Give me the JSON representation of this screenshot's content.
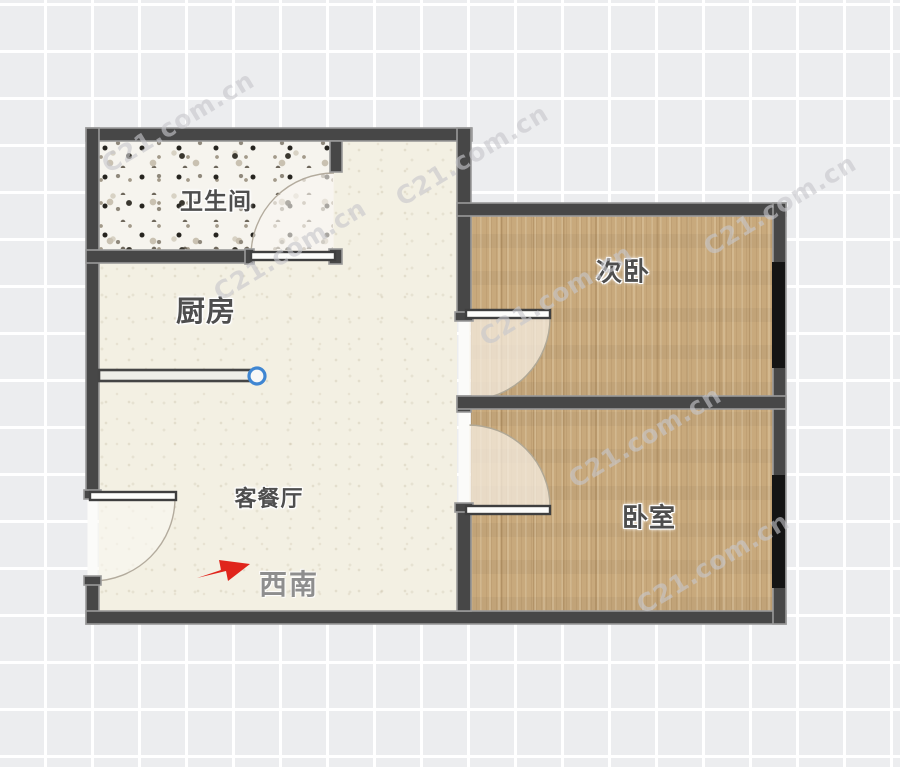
{
  "page": {
    "background_color": "#ecedef",
    "grid_line_color": "#ffffff"
  },
  "floor_plan": {
    "rooms": [
      {
        "id": "bathroom",
        "label": "卫生间",
        "floor": "terrazzo"
      },
      {
        "id": "kitchen",
        "label": "厨房",
        "floor": "cream"
      },
      {
        "id": "living-dining",
        "label": "客餐厅",
        "floor": "cream"
      },
      {
        "id": "second-bedroom",
        "label": "次卧",
        "floor": "wood"
      },
      {
        "id": "bedroom",
        "label": "卧室",
        "floor": "wood"
      }
    ],
    "orientation": {
      "label": "西南",
      "arrow_direction": "right",
      "arrow_color": "#e0251c"
    },
    "doors": [
      {
        "room": "bathroom",
        "swing": "into-bathroom"
      },
      {
        "room": "entrance",
        "swing": "into-living"
      },
      {
        "room": "second-bedroom",
        "swing": "into-second-bedroom"
      },
      {
        "room": "bedroom",
        "swing": "into-bedroom"
      }
    ],
    "windows": [
      {
        "room": "second-bedroom",
        "wall": "right"
      },
      {
        "room": "bedroom",
        "wall": "right"
      }
    ],
    "colors": {
      "wall": "#474747",
      "wall_edge": "#9a9a9a",
      "window_band": "#141414",
      "wood": "#c8a97c",
      "terrazzo_base": "#f6f4ee",
      "cream_floor": "#f3f0e3",
      "selection_handle_blue": "#3f86d2"
    }
  },
  "watermark": {
    "text": "C21.com.cn"
  }
}
